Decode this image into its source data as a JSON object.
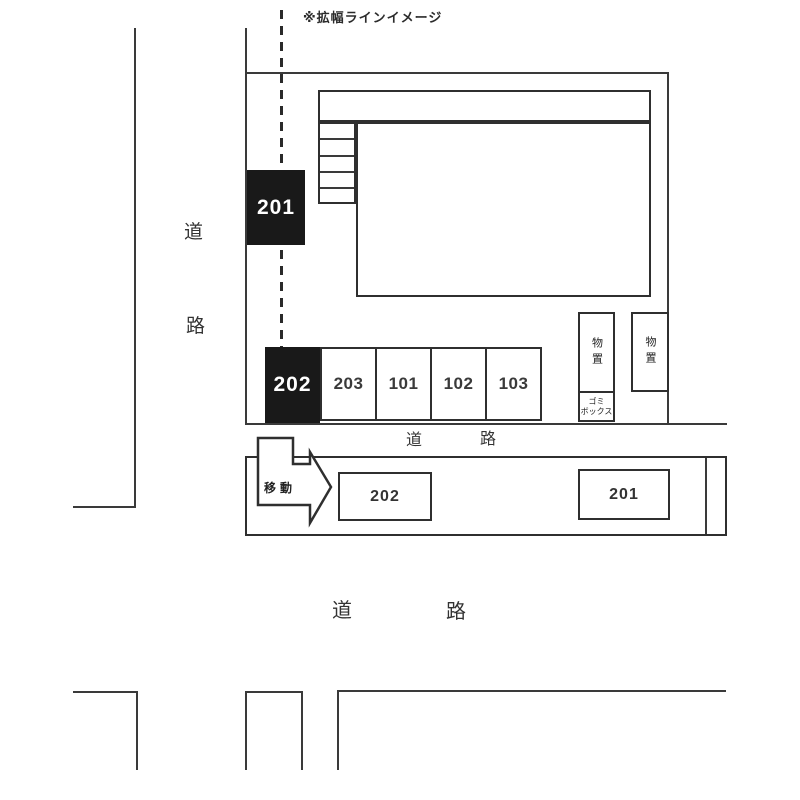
{
  "annotation": {
    "widening_line_label": "※拡幅ラインイメージ"
  },
  "roads": {
    "left": {
      "char_1": "道",
      "char_2": "路"
    },
    "middle": {
      "char_1": "道",
      "char_2": "路"
    },
    "bottom": {
      "char_1": "道",
      "char_2": "路"
    }
  },
  "site": {
    "unit_201_label": "201",
    "unit_202_label": "202",
    "parking_spaces": [
      "203",
      "101",
      "102",
      "103"
    ],
    "storage_left_label": "物置",
    "storage_right_label": "物置",
    "garbage_box_line1": "ゴミ",
    "garbage_box_line2": "ボックス"
  },
  "relocation": {
    "move_label": "移動",
    "relocated_202_label": "202",
    "relocated_201_label": "201"
  },
  "colors": {
    "line": "#3a3a3a",
    "black_box_fill": "#191919",
    "black_box_text": "#ffffff"
  }
}
